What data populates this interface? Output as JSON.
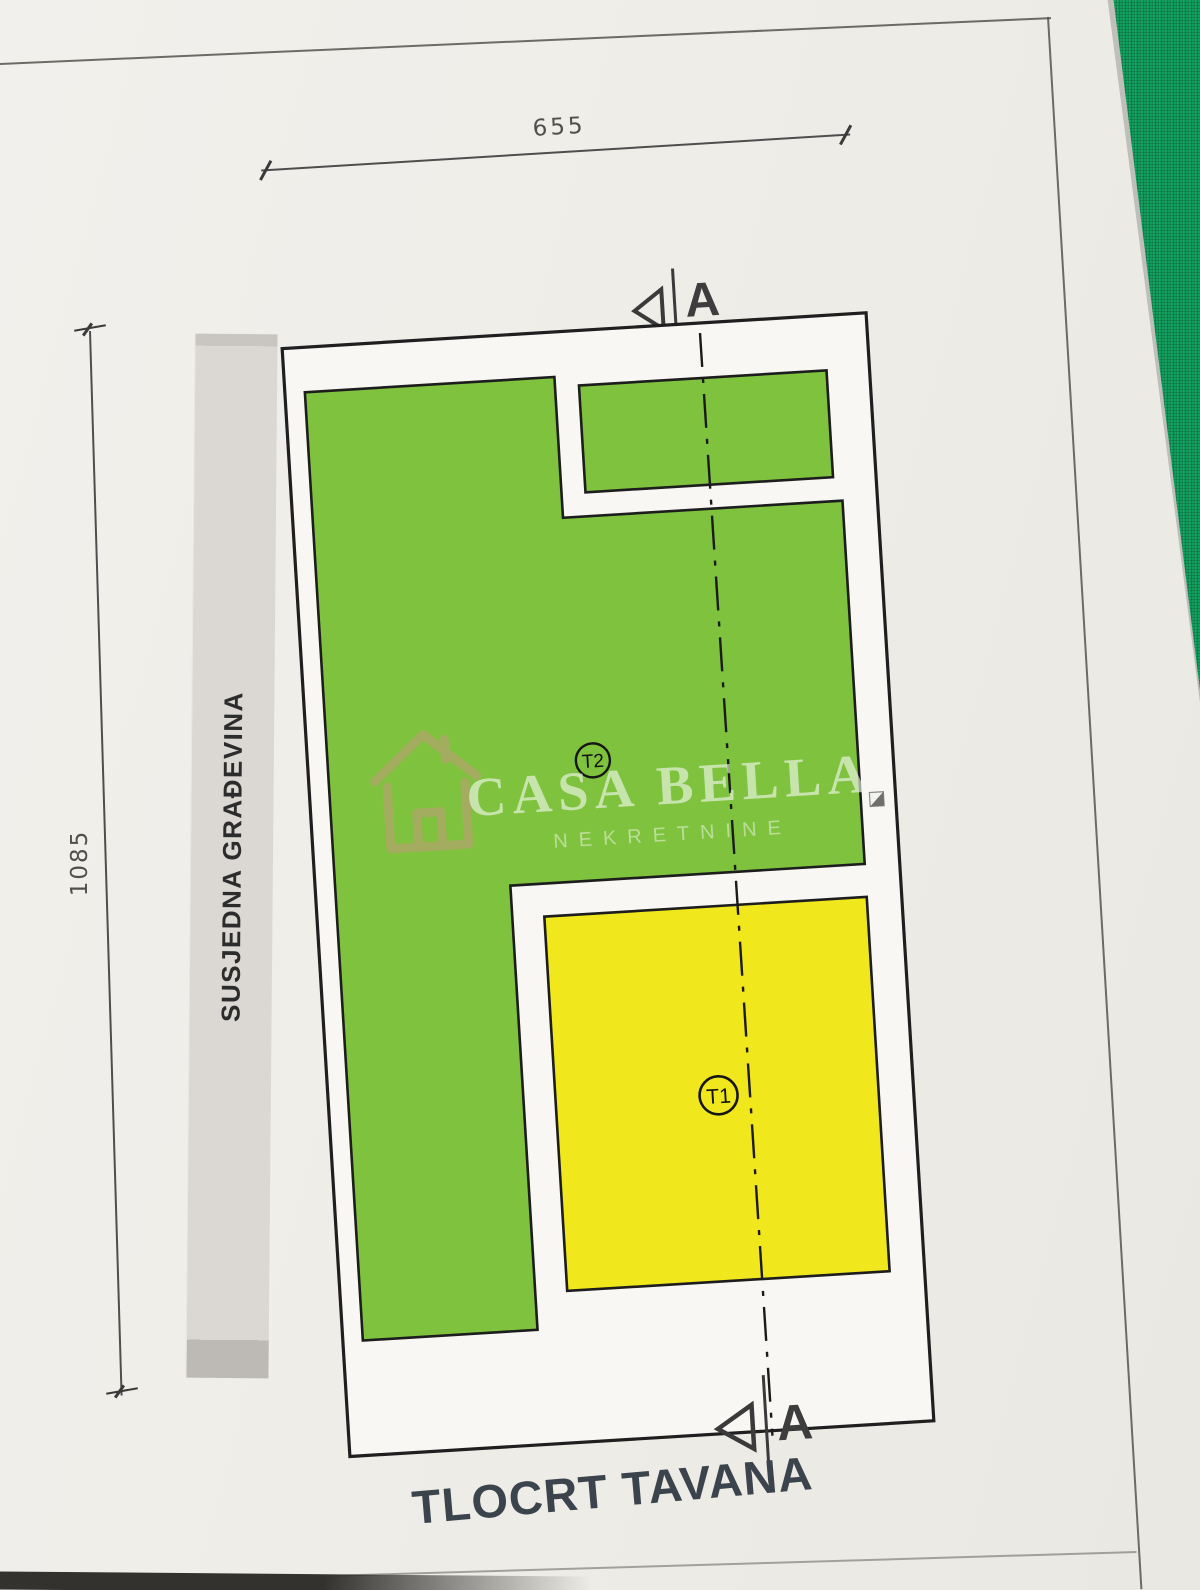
{
  "document": {
    "title": "TLOCRT TAVANA",
    "dimensions": {
      "top_width": "655",
      "left_height": "1085"
    },
    "neighbor_label": "SUSJEDNA GRAĐEVINA",
    "rooms": {
      "t1_label": "T1",
      "t2_label": "T2"
    },
    "section": {
      "letter": "A"
    },
    "watermark": {
      "brand": "CASA BELLA",
      "subtitle": "NEKRETNINE"
    },
    "colors": {
      "room_green": "#7ec23e",
      "room_yellow": "#f0e71d",
      "wall": "#1f1f1f",
      "paper": "#efede8",
      "fabric_green": "#0f9f5c",
      "watermark_tan": "#c49b7d",
      "title_ink": "#3b444c"
    },
    "icons": {
      "house": "house-outline-watermark",
      "section_marker": "section-cut-arrow",
      "anchor": "object-anchor-square"
    }
  }
}
